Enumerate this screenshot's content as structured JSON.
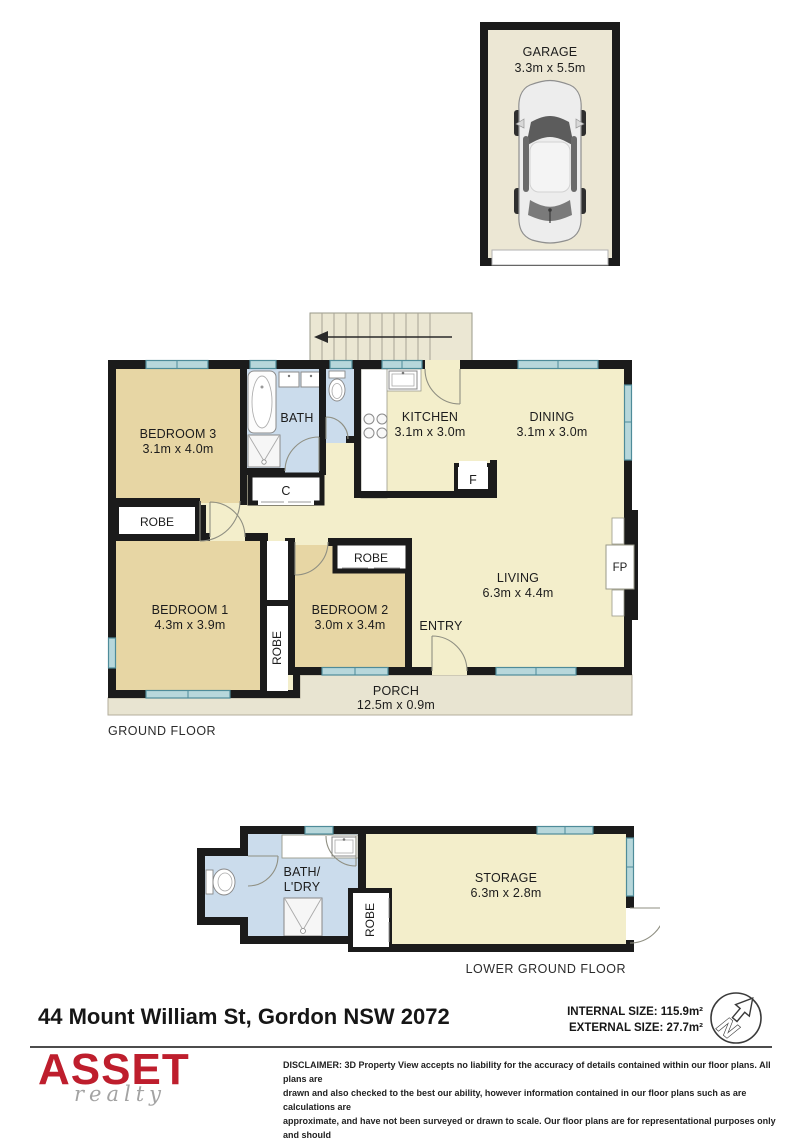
{
  "garage": {
    "title": "GARAGE",
    "dims": "3.3m x 5.5m"
  },
  "ground_floor": {
    "floor_label": "GROUND FLOOR",
    "bedroom3": {
      "name": "BEDROOM 3",
      "dims": "3.1m x 4.0m"
    },
    "bath": {
      "name": "BATH"
    },
    "kitchen": {
      "name": "KITCHEN",
      "dims": "3.1m x 3.0m"
    },
    "dining": {
      "name": "DINING",
      "dims": "3.1m x 3.0m"
    },
    "living": {
      "name": "LIVING",
      "dims": "6.3m x 4.4m"
    },
    "bedroom1": {
      "name": "BEDROOM 1",
      "dims": "4.3m x 3.9m"
    },
    "bedroom2": {
      "name": "BEDROOM 2",
      "dims": "3.0m x 3.4m"
    },
    "entry": {
      "name": "ENTRY"
    },
    "porch": {
      "name": "PORCH",
      "dims": "12.5m x 0.9m"
    },
    "robe_label": "ROBE",
    "closet_label": "C",
    "fridge_label": "F",
    "fireplace_label": "FP"
  },
  "lower_ground_floor": {
    "floor_label": "LOWER GROUND FLOOR",
    "bath_ldry": {
      "line1": "BATH/",
      "line2": "L'DRY"
    },
    "storage": {
      "name": "STORAGE",
      "dims": "6.3m x 2.8m"
    },
    "robe_label": "ROBE"
  },
  "title_block": {
    "address": "44 Mount William St, Gordon NSW 2072",
    "internal_size": "INTERNAL SIZE: 115.9m²",
    "external_size": "EXTERNAL SIZE: 27.7m²",
    "compass_letter": "N"
  },
  "branding": {
    "logo": "ASSET",
    "logo_sub": "realty"
  },
  "disclaimer": {
    "lines": [
      "DISCLAIMER: 3D Property View accepts no liability for the accuracy of details contained within our floor plans. All plans are",
      "drawn and also checked to the best our ability, however information contained in our floor plans such as are calculations are",
      "approximate, and have not been surveyed or drawn to scale. Our floor plans are for representational purposes only and should",
      "be used as such. Do not attempt to refer to our floor plans for structural or detailed information."
    ]
  },
  "colors": {
    "wall": "#1b1b1b",
    "room_tan": "#e7d6a4",
    "room_cream": "#f3eecb",
    "room_blue": "#cbdcec",
    "porch_gray": "#e8e4d1",
    "window_teal": "#b7d7db",
    "logo_red": "#be1e2d"
  }
}
